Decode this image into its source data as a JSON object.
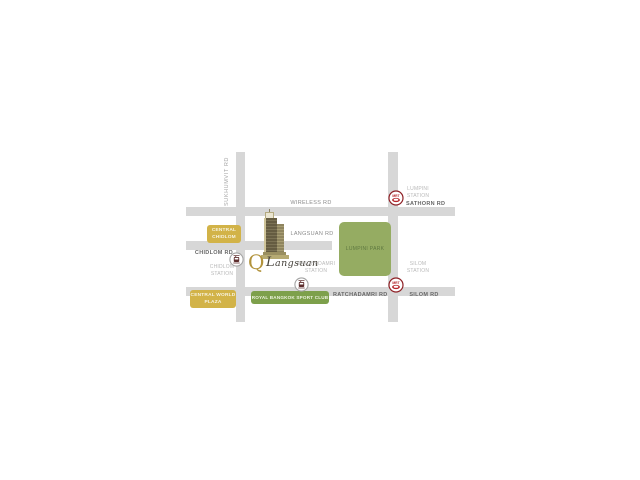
{
  "map": {
    "name": "Q Langsuan location map",
    "logo": {
      "q": "Q",
      "name": "Langsuan"
    },
    "roads": {
      "sukhumvit": "SUKHUMVIT RD",
      "wireless": "WIRELESS RD",
      "sathorn": "SATHORN RD",
      "langsuan": "LANGSUAN RD",
      "chidlom": "CHIDLOM RD",
      "ratchadamri": "RATCHADAMRI RD",
      "silom": "SILOM RD"
    },
    "stations": {
      "chidlom": {
        "line1": "CHIDLOM",
        "line2": "STATION"
      },
      "ratchadamri": {
        "line1": "RATCHADAMRI",
        "line2": "STATION"
      },
      "lumpini": {
        "line1": "LUMPINI",
        "line2": "STATION"
      },
      "silom": {
        "line1": "SILOM",
        "line2": "STATION"
      }
    },
    "places": {
      "central_chidlom": {
        "line1": "CENTRAL",
        "line2": "CHIDLOM"
      },
      "central_world_plaza": {
        "line1": "CENTRAL WORLD",
        "line2": "PLAZA"
      },
      "royal_bangkok_sport_club": "ROYAL BANGKOK SPORT CLUB",
      "lumpini_park": "LUMPINI PARK"
    },
    "transit": {
      "mrt_label": "MRT"
    },
    "colors": {
      "road": "#d7d7d7",
      "gold_box": "#d2b348",
      "sport_club_green": "#7da04b",
      "park_green": "#95ac62",
      "logo_gold": "#b2933c",
      "mrt_red": "#9c2328",
      "bts_maroon": "#5d2d2d"
    }
  }
}
